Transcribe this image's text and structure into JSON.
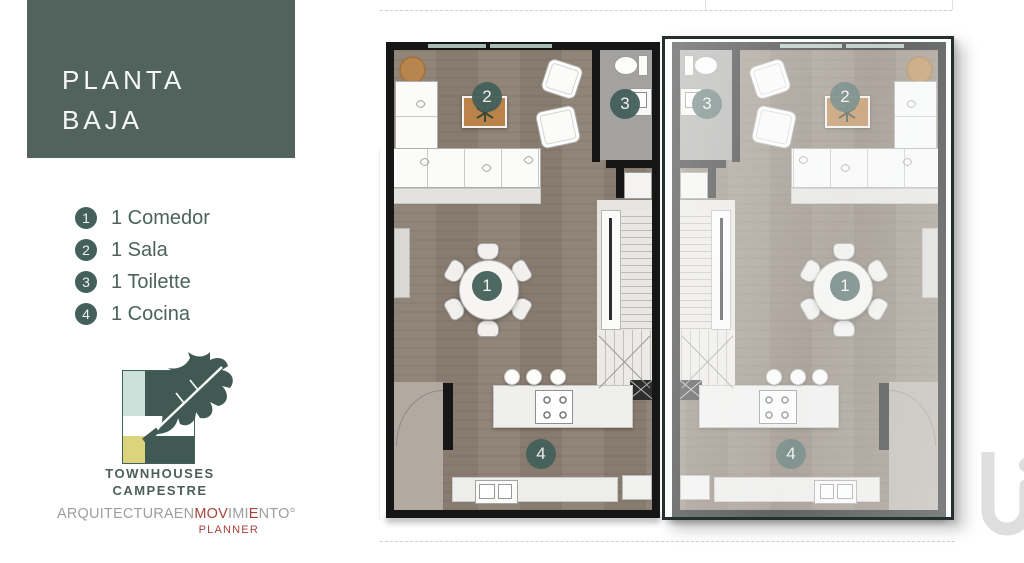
{
  "slide": {
    "title": {
      "line1": "PLANTA",
      "line2": "BAJA"
    },
    "legend": {
      "items": [
        {
          "num": "1",
          "label": "1 Comedor"
        },
        {
          "num": "2",
          "label": "1 Sala"
        },
        {
          "num": "3",
          "label": "1 Toilette"
        },
        {
          "num": "4",
          "label": "1 Cocina"
        }
      ]
    },
    "logo": {
      "name_line1": "TOWNHOUSES",
      "name_line2": "CAMPESTRE"
    },
    "brand": {
      "segments": [
        {
          "text": "ARQUITECTURAEN",
          "tone": "gray"
        },
        {
          "text": "MOV",
          "tone": "red"
        },
        {
          "text": "IMI",
          "tone": "gray"
        },
        {
          "text": "E",
          "tone": "red"
        },
        {
          "text": "NTO",
          "tone": "gray"
        },
        {
          "text": "°",
          "tone": "gray"
        }
      ],
      "sub": "PLANNER"
    }
  },
  "floorplan": {
    "markers": {
      "comedor": "1",
      "sala": "2",
      "toilette": "3",
      "cocina": "4"
    }
  },
  "colors": {
    "title_block_green": "#52635e",
    "badge_green": "#44605a",
    "brand_red": "#a8433c",
    "brand_gray": "#9e9e9e",
    "floor_brown": "#8d8074",
    "glass_border": "#24302f",
    "logo_mint": "#cde0d9",
    "logo_yellow": "#dbd47c",
    "logo_green": "#405a53"
  }
}
